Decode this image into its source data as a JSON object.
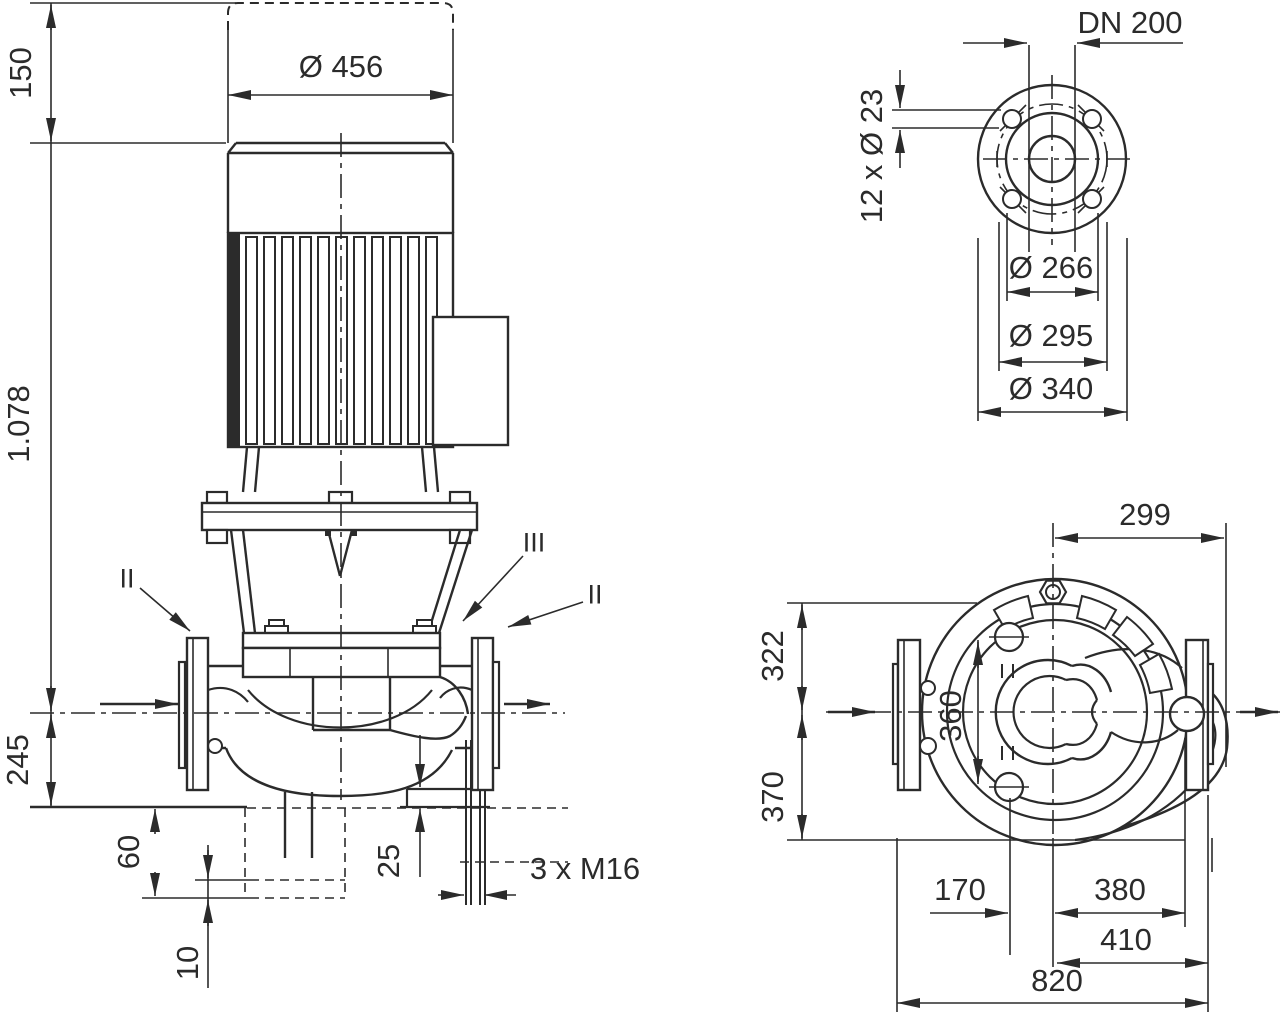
{
  "drawing": {
    "kind": "pump-technical-dimension-drawing",
    "background": "#ffffff",
    "line_color": "#2b2b2b"
  },
  "front_view": {
    "dim_150": "150",
    "dim_1078": "1.078",
    "dim_245": "245",
    "dim_dia456": "Ø 456",
    "dim_60": "60",
    "dim_10": "10",
    "dim_25": "25",
    "dim_anchor_bolts": "3 x M16",
    "label_section_II_left": "II",
    "label_section_III": "III",
    "label_section_II_right": "II"
  },
  "flange_view": {
    "dim_dn": "DN 200",
    "dim_bolt_holes": "12 x Ø 23",
    "dim_dia266": "Ø 266",
    "dim_dia295": "Ø 295",
    "dim_dia340": "Ø 340"
  },
  "plan_view": {
    "dim_299": "299",
    "dim_322": "322",
    "dim_370": "370",
    "dim_360": "360",
    "dim_170": "170",
    "dim_380": "380",
    "dim_410": "410",
    "dim_820": "820"
  }
}
